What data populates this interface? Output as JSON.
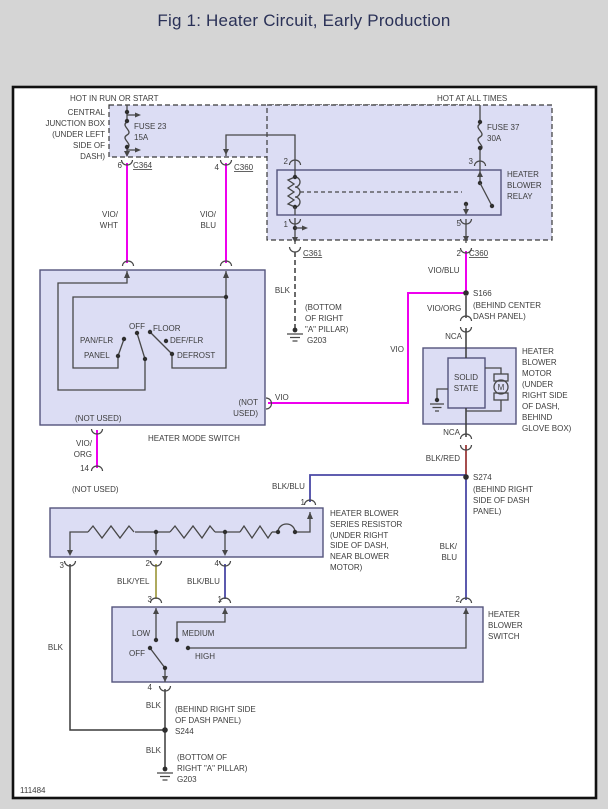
{
  "title": "Fig 1: Heater Circuit, Early Production",
  "figure_number": "111484",
  "colors": {
    "page_background": "#d5d5d5",
    "panel_background": "#ffffff",
    "component_fill": "#dcddf4",
    "wire_violet": "#ee00ee",
    "wire_blue": "#4948a5",
    "wire_yellow": "#a5a04c",
    "wire_red": "#9c3a3a",
    "wire_black": "#3a3a3a",
    "text": "#3d3d3d",
    "title_text": "#2a3157"
  },
  "labels": [
    {
      "n": "hot-in-run-or-start",
      "t": "HOT IN RUN OR START",
      "x": 70,
      "y": 101
    },
    {
      "n": "hot-at-all-times",
      "t": "HOT AT ALL TIMES",
      "x": 437,
      "y": 101
    },
    {
      "n": "cjb-line-1",
      "t": "CENTRAL",
      "x": 105,
      "y": 115,
      "a": "e"
    },
    {
      "n": "cjb-line-2",
      "t": "JUNCTION BOX",
      "x": 105,
      "y": 126,
      "a": "e"
    },
    {
      "n": "cjb-line-3",
      "t": "(UNDER LEFT",
      "x": 105,
      "y": 137,
      "a": "e"
    },
    {
      "n": "cjb-line-4",
      "t": "SIDE OF",
      "x": 105,
      "y": 148,
      "a": "e"
    },
    {
      "n": "cjb-line-5",
      "t": "DASH)",
      "x": 105,
      "y": 159,
      "a": "e"
    },
    {
      "n": "fuse23-name",
      "t": "FUSE 23",
      "x": 134,
      "y": 129
    },
    {
      "n": "fuse23-rating",
      "t": "15A",
      "x": 134,
      "y": 140
    },
    {
      "n": "fuse37-name",
      "t": "FUSE 37",
      "x": 487,
      "y": 130
    },
    {
      "n": "fuse37-rating",
      "t": "30A",
      "x": 487,
      "y": 141
    },
    {
      "n": "pin-6",
      "t": "6",
      "x": 122,
      "y": 168,
      "a": "e"
    },
    {
      "n": "conn-c364",
      "t": "C364",
      "x": 133,
      "y": 168,
      "u": 1
    },
    {
      "n": "pin-4",
      "t": "4",
      "x": 219,
      "y": 170,
      "a": "e"
    },
    {
      "n": "conn-c360-top",
      "t": "C360",
      "x": 234,
      "y": 170,
      "u": 1
    },
    {
      "n": "wire-vio-wht-1",
      "t": "VIO/",
      "x": 118,
      "y": 217,
      "a": "e"
    },
    {
      "n": "wire-vio-wht-2",
      "t": "WHT",
      "x": 118,
      "y": 228,
      "a": "e"
    },
    {
      "n": "wire-vio-blu-left-1",
      "t": "VIO/",
      "x": 216,
      "y": 217,
      "a": "e"
    },
    {
      "n": "wire-vio-blu-left-2",
      "t": "BLU",
      "x": 216,
      "y": 228,
      "a": "e"
    },
    {
      "n": "relay-pin-2",
      "t": "2",
      "x": 288,
      "y": 164,
      "a": "e"
    },
    {
      "n": "relay-pin-3",
      "t": "3",
      "x": 473,
      "y": 164,
      "a": "e"
    },
    {
      "n": "relay-pin-1",
      "t": "1",
      "x": 288,
      "y": 227,
      "a": "e"
    },
    {
      "n": "relay-pin-5",
      "t": "5",
      "x": 461,
      "y": 226,
      "a": "e"
    },
    {
      "n": "relay-label-1",
      "t": "HEATER",
      "x": 507,
      "y": 177
    },
    {
      "n": "relay-label-2",
      "t": "BLOWER",
      "x": 507,
      "y": 188
    },
    {
      "n": "relay-label-3",
      "t": "RELAY",
      "x": 507,
      "y": 199
    },
    {
      "n": "conn-c361",
      "t": "C361",
      "x": 303,
      "y": 256,
      "u": 1
    },
    {
      "n": "wire-blk-c361",
      "t": "BLK",
      "x": 290,
      "y": 293,
      "a": "e"
    },
    {
      "n": "g203-mid-loc-1",
      "t": "(BOTTOM",
      "x": 305,
      "y": 310
    },
    {
      "n": "g203-mid-loc-2",
      "t": "OF RIGHT",
      "x": 305,
      "y": 321
    },
    {
      "n": "g203-mid-loc-3",
      "t": "\"A\" PILLAR)",
      "x": 305,
      "y": 332
    },
    {
      "n": "g203-mid",
      "t": "G203",
      "x": 307,
      "y": 343
    },
    {
      "n": "pin-2-c360",
      "t": "2",
      "x": 461,
      "y": 256,
      "a": "e"
    },
    {
      "n": "conn-c360-right",
      "t": "C360",
      "x": 469,
      "y": 256,
      "u": 1
    },
    {
      "n": "wire-vio-blu-right",
      "t": "VIO/BLU",
      "x": 428,
      "y": 273
    },
    {
      "n": "splice-s166",
      "t": "S166",
      "x": 473,
      "y": 296
    },
    {
      "n": "s166-loc-1",
      "t": "(BEHIND CENTER",
      "x": 473,
      "y": 308
    },
    {
      "n": "s166-loc-2",
      "t": "DASH PANEL)",
      "x": 473,
      "y": 319
    },
    {
      "n": "wire-vio-org-right",
      "t": "VIO/ORG",
      "x": 427,
      "y": 311
    },
    {
      "n": "wire-nca-top",
      "t": "NCA",
      "x": 462,
      "y": 339,
      "a": "e"
    },
    {
      "n": "motor-label-1",
      "t": "HEATER",
      "x": 522,
      "y": 354
    },
    {
      "n": "motor-label-2",
      "t": "BLOWER",
      "x": 522,
      "y": 365
    },
    {
      "n": "motor-label-3",
      "t": "MOTOR",
      "x": 522,
      "y": 376
    },
    {
      "n": "motor-label-4",
      "t": "(UNDER",
      "x": 522,
      "y": 387
    },
    {
      "n": "motor-label-5",
      "t": "RIGHT SIDE",
      "x": 522,
      "y": 398
    },
    {
      "n": "motor-label-6",
      "t": "OF DASH,",
      "x": 522,
      "y": 409
    },
    {
      "n": "motor-label-7",
      "t": "BEHIND",
      "x": 522,
      "y": 420
    },
    {
      "n": "motor-label-8",
      "t": "GLOVE BOX)",
      "x": 522,
      "y": 431
    },
    {
      "n": "solid-state-1",
      "t": "SOLID",
      "x": 466,
      "y": 380,
      "a": "m"
    },
    {
      "n": "solid-state-2",
      "t": "STATE",
      "x": 466,
      "y": 391,
      "a": "m"
    },
    {
      "n": "motor-m",
      "t": "M",
      "x": 501,
      "y": 390,
      "a": "m",
      "s": 9
    },
    {
      "n": "wire-nca-bottom",
      "t": "NCA",
      "x": 460,
      "y": 435,
      "a": "e"
    },
    {
      "n": "wire-blk-red",
      "t": "BLK/RED",
      "x": 460,
      "y": 461,
      "a": "e"
    },
    {
      "n": "splice-s274",
      "t": "S274",
      "x": 473,
      "y": 480
    },
    {
      "n": "s274-loc-1",
      "t": "(BEHIND RIGHT",
      "x": 473,
      "y": 492
    },
    {
      "n": "s274-loc-2",
      "t": "SIDE OF DASH",
      "x": 473,
      "y": 503
    },
    {
      "n": "s274-loc-3",
      "t": "PANEL)",
      "x": 473,
      "y": 514
    },
    {
      "n": "wire-blk-blu-top",
      "t": "BLK/BLU",
      "x": 272,
      "y": 489
    },
    {
      "n": "resistor-pin-1",
      "t": "1",
      "x": 305,
      "y": 505,
      "a": "e"
    },
    {
      "n": "resistor-label-1",
      "t": "HEATER BLOWER",
      "x": 330,
      "y": 516
    },
    {
      "n": "resistor-label-2",
      "t": "SERIES RESISTOR",
      "x": 330,
      "y": 527
    },
    {
      "n": "resistor-label-3",
      "t": "(UNDER RIGHT",
      "x": 330,
      "y": 538
    },
    {
      "n": "resistor-label-4",
      "t": "SIDE OF DASH,",
      "x": 330,
      "y": 548
    },
    {
      "n": "resistor-label-5",
      "t": "NEAR BLOWER",
      "x": 330,
      "y": 559
    },
    {
      "n": "resistor-label-6",
      "t": "MOTOR)",
      "x": 330,
      "y": 570
    },
    {
      "n": "wire-blk-blu-vert-1",
      "t": "BLK/",
      "x": 457,
      "y": 549,
      "a": "e"
    },
    {
      "n": "wire-blk-blu-vert-2",
      "t": "BLU",
      "x": 457,
      "y": 560,
      "a": "e"
    },
    {
      "n": "resistor-pin-3",
      "t": "3",
      "x": 64,
      "y": 568,
      "a": "e"
    },
    {
      "n": "resistor-pin-2",
      "t": "2",
      "x": 150,
      "y": 566,
      "a": "e"
    },
    {
      "n": "resistor-pin-4",
      "t": "4",
      "x": 219,
      "y": 566,
      "a": "e"
    },
    {
      "n": "wire-blk-yel",
      "t": "BLK/YEL",
      "x": 117,
      "y": 584
    },
    {
      "n": "wire-blk-blu-mid",
      "t": "BLK/BLU",
      "x": 187,
      "y": 584
    },
    {
      "n": "switch-pin-3",
      "t": "3",
      "x": 152,
      "y": 602,
      "a": "e"
    },
    {
      "n": "switch-pin-1",
      "t": "1",
      "x": 222,
      "y": 602,
      "a": "e"
    },
    {
      "n": "switch-pin-2",
      "t": "2",
      "x": 460,
      "y": 602,
      "a": "e"
    },
    {
      "n": "blower-switch-label-1",
      "t": "HEATER",
      "x": 488,
      "y": 617
    },
    {
      "n": "blower-switch-label-2",
      "t": "BLOWER",
      "x": 488,
      "y": 628
    },
    {
      "n": "blower-switch-label-3",
      "t": "SWITCH",
      "x": 488,
      "y": 639
    },
    {
      "n": "pos-low",
      "t": "LOW",
      "x": 132,
      "y": 636
    },
    {
      "n": "pos-medium",
      "t": "MEDIUM",
      "x": 182,
      "y": 636
    },
    {
      "n": "pos-off-blower",
      "t": "OFF",
      "x": 129,
      "y": 656
    },
    {
      "n": "pos-high",
      "t": "HIGH",
      "x": 195,
      "y": 659
    },
    {
      "n": "switch-pin-4",
      "t": "4",
      "x": 152,
      "y": 690,
      "a": "e"
    },
    {
      "n": "wire-blk-switch",
      "t": "BLK",
      "x": 161,
      "y": 708,
      "a": "e"
    },
    {
      "n": "s244-loc-1",
      "t": "(BEHIND RIGHT SIDE",
      "x": 175,
      "y": 712
    },
    {
      "n": "s244-loc-2",
      "t": "OF DASH PANEL)",
      "x": 175,
      "y": 723
    },
    {
      "n": "splice-s244",
      "t": "S244",
      "x": 175,
      "y": 734
    },
    {
      "n": "wire-blk-s244",
      "t": "BLK",
      "x": 161,
      "y": 753,
      "a": "e"
    },
    {
      "n": "g203-bot-loc-1",
      "t": "(BOTTOM OF",
      "x": 177,
      "y": 760
    },
    {
      "n": "g203-bot-loc-2",
      "t": "RIGHT \"A\" PILLAR)",
      "x": 177,
      "y": 771
    },
    {
      "n": "g203-bot",
      "t": "G203",
      "x": 177,
      "y": 782
    },
    {
      "n": "wire-blk-long",
      "t": "BLK",
      "x": 63,
      "y": 650,
      "a": "e"
    },
    {
      "n": "pos-pan-flr",
      "t": "PAN/FLR",
      "x": 80,
      "y": 343
    },
    {
      "n": "pos-panel",
      "t": "PANEL",
      "x": 84,
      "y": 358
    },
    {
      "n": "pos-off-mode",
      "t": "OFF",
      "x": 129,
      "y": 329
    },
    {
      "n": "pos-floor",
      "t": "FLOOR",
      "x": 153,
      "y": 331
    },
    {
      "n": "pos-def-flr",
      "t": "DEF/FLR",
      "x": 170,
      "y": 343
    },
    {
      "n": "pos-defrost",
      "t": "DEFROST",
      "x": 177,
      "y": 358
    },
    {
      "n": "mode-not-used-inside",
      "t": "(NOT USED)",
      "x": 75,
      "y": 421
    },
    {
      "n": "mode-not-used-right-1",
      "t": "(NOT",
      "x": 258,
      "y": 405,
      "a": "e"
    },
    {
      "n": "mode-not-used-right-2",
      "t": "USED)",
      "x": 258,
      "y": 416,
      "a": "e"
    },
    {
      "n": "wire-vio-exit",
      "t": "VIO",
      "x": 275,
      "y": 400
    },
    {
      "n": "wire-vio-vert",
      "t": "VIO",
      "x": 404,
      "y": 352,
      "a": "e"
    },
    {
      "n": "mode-switch-name",
      "t": "HEATER MODE SWITCH",
      "x": 148,
      "y": 441
    },
    {
      "n": "wire-vio-org-left-1",
      "t": "VIO/",
      "x": 92,
      "y": 446,
      "a": "e"
    },
    {
      "n": "wire-vio-org-left-2",
      "t": "ORG",
      "x": 92,
      "y": 457,
      "a": "e"
    },
    {
      "n": "pin-14",
      "t": "14",
      "x": 89,
      "y": 471,
      "a": "e"
    },
    {
      "n": "mode-not-used-bottom",
      "t": "(NOT USED)",
      "x": 72,
      "y": 492
    },
    {
      "n": "figure-number",
      "t": "111484",
      "x": 20,
      "y": 793
    }
  ]
}
